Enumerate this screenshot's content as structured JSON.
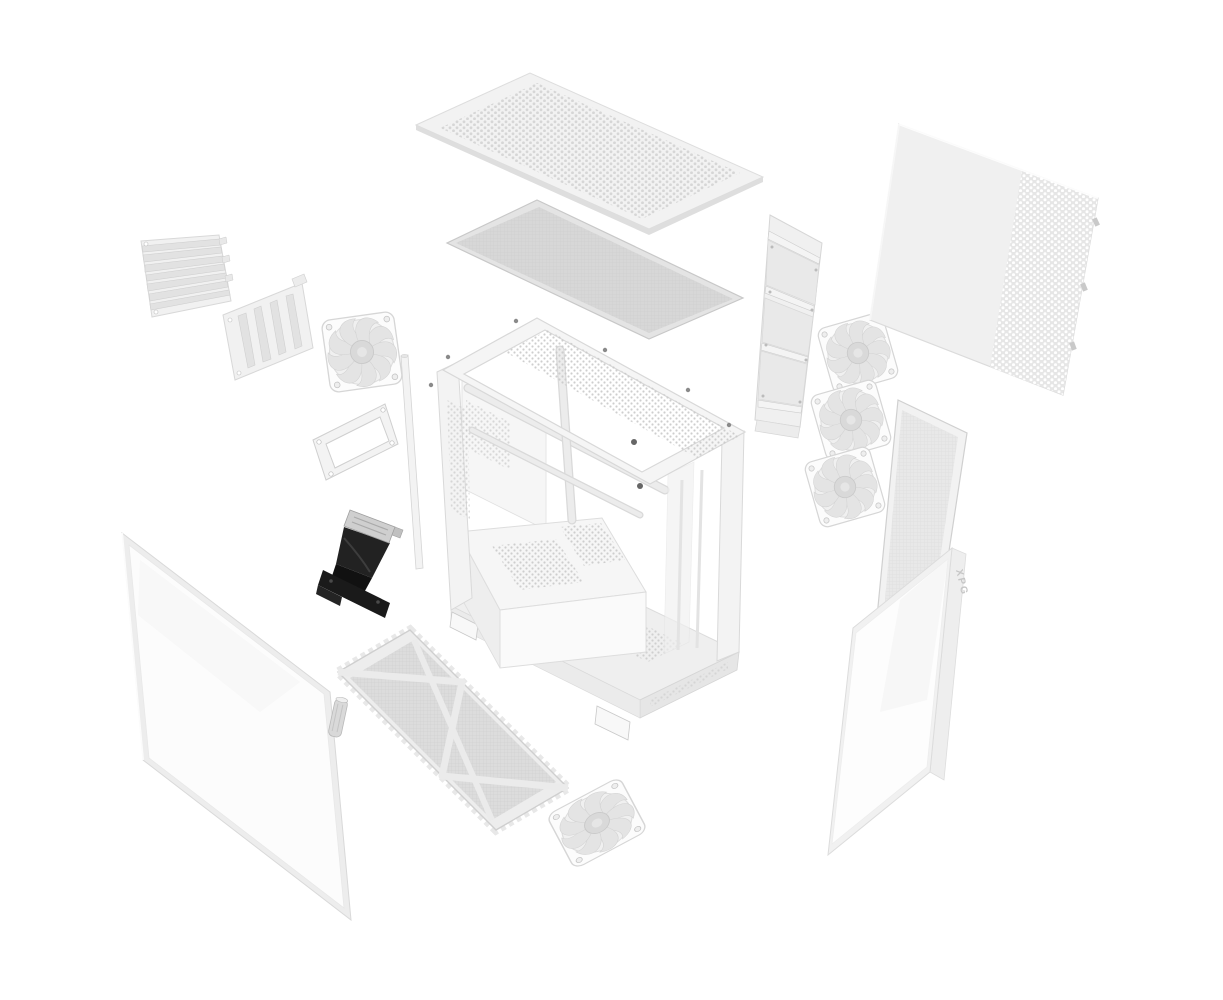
{
  "page": {
    "title": "PC case exploded view render",
    "background_color": "#ffffff"
  },
  "brand": {
    "label": "XPG"
  },
  "colors": {
    "part_white": "#f2f2f2",
    "part_border": "#d8d8d8",
    "mesh_gray": "#d9d9d9",
    "perforation_dot": "#d4d4d4",
    "honeycomb_dot": "#c9c9c9",
    "riser_black": "#1c1c1c",
    "glass_tint": "#fbfbfb"
  },
  "parts": [
    {
      "id": "top-exhaust-panel",
      "label": "perforated top panel"
    },
    {
      "id": "top-dust-filter",
      "label": "top mesh dust filter"
    },
    {
      "id": "pci-slot-bracket",
      "label": "PCI slot cover bracket"
    },
    {
      "id": "vertical-gpu-bracket",
      "label": "vertical GPU mount bracket"
    },
    {
      "id": "rear-fan",
      "label": "120mm cooling fan"
    },
    {
      "id": "support-rod",
      "label": "support rod"
    },
    {
      "id": "io-bracket-frame",
      "label": "rectangular bracket frame"
    },
    {
      "id": "pcie-riser-cable",
      "label": "PCIe riser cable"
    },
    {
      "id": "main-chassis",
      "label": "chassis frame with PSU shroud"
    },
    {
      "id": "fan-mount-bracket",
      "label": "side fan mounting bracket"
    },
    {
      "id": "fan-stack",
      "label": "three stacked 120mm fans"
    },
    {
      "id": "side-panel-solid",
      "label": "solid side panel with perforated strip"
    },
    {
      "id": "front-mesh-panel",
      "label": "narrow mesh panel"
    },
    {
      "id": "tempered-glass-panel-right",
      "label": "tempered glass side panel"
    },
    {
      "id": "tempered-glass-panel-left",
      "label": "tempered glass front panel"
    },
    {
      "id": "standoff-pin",
      "label": "cylindrical standoff pin"
    },
    {
      "id": "bottom-dust-filter",
      "label": "bottom dust filter with cross bracing"
    },
    {
      "id": "bottom-fan",
      "label": "120mm cooling fan (bottom)"
    }
  ]
}
